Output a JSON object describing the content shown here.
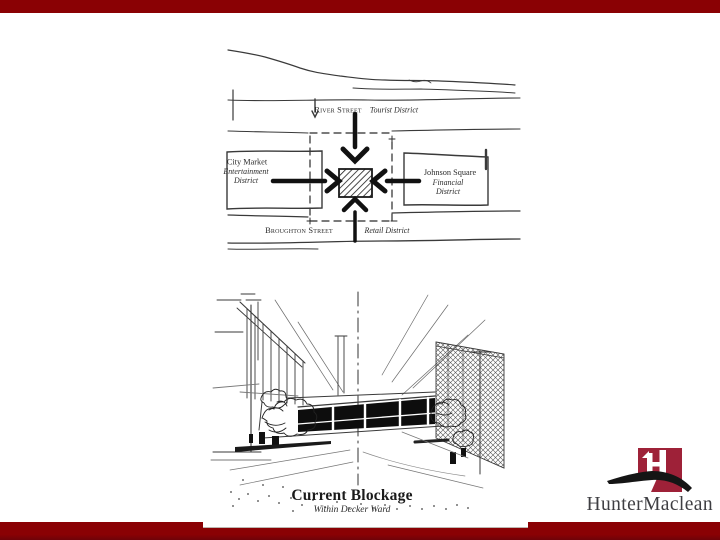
{
  "slide": {
    "map_diagram": {
      "north_label": "River Street",
      "north_sublabel": "Tourist District",
      "west_title": "City Market",
      "west_line2": "Entertainment",
      "west_line3": "District",
      "east_title": "Johnson Square",
      "east_line2": "Financial",
      "east_line3": "District",
      "south_label": "Broughton Street",
      "south_sublabel": "Retail District"
    },
    "sketch_caption": {
      "title": "Current Blockage",
      "subtitle": "Within Decker Ward"
    }
  },
  "logo": {
    "wordmark": "HunterMaclean"
  },
  "colors": {
    "bar_red": "#8a0104",
    "logo_red": "#9e2138",
    "ink": "#2e2e2e"
  }
}
